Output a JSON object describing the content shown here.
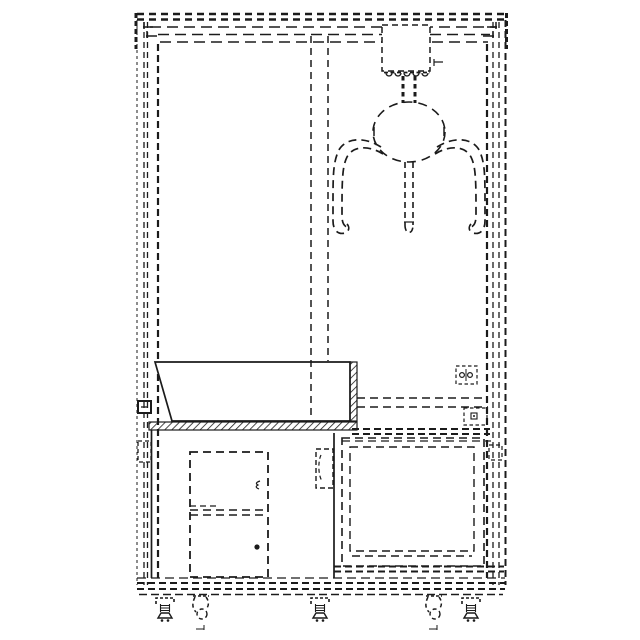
{
  "figure": {
    "title": "Claw crane prize machine - front elevation, dashed patent-style line drawing",
    "style": "black dashed line art on white, no text labels",
    "components": {
      "top_header": "top header / marquee frame band",
      "cabinet_frame_left": "left cabinet frame posts",
      "cabinet_frame_right": "right cabinet frame posts",
      "play_window_divider": "vertical play-window partition lines",
      "carriage": "overhead claw carriage box with rail rollers",
      "hanger": "claw suspension bars",
      "claw_head": "round claw head",
      "claw_arms": "two curved outer claw fingers",
      "claw_center_finger": "straight center claw finger",
      "prize_bin": "solid-line prize bin / tray with hatched edge",
      "shelf": "hatched shelf bar under bin",
      "left_lower_cabinet": "lower-left cabinet",
      "upper_door": "upper service door with latch",
      "lower_door": "lower service door with knob",
      "door_bracket": "hinge bracket between cabinets",
      "right_chamber": "lower-right chamber with inner panel",
      "step_ledge": "right-side step ledge lines",
      "sensor_block_a": "small twin-roller block on right wall",
      "sensor_block_b": "small latch block on right wall",
      "base": "base frame bands",
      "leveling_feet": "three adjustable leveling feet",
      "casters": "two swivel casters"
    }
  },
  "colors": {
    "background": "#ffffff",
    "line": "#1b1b1b"
  }
}
